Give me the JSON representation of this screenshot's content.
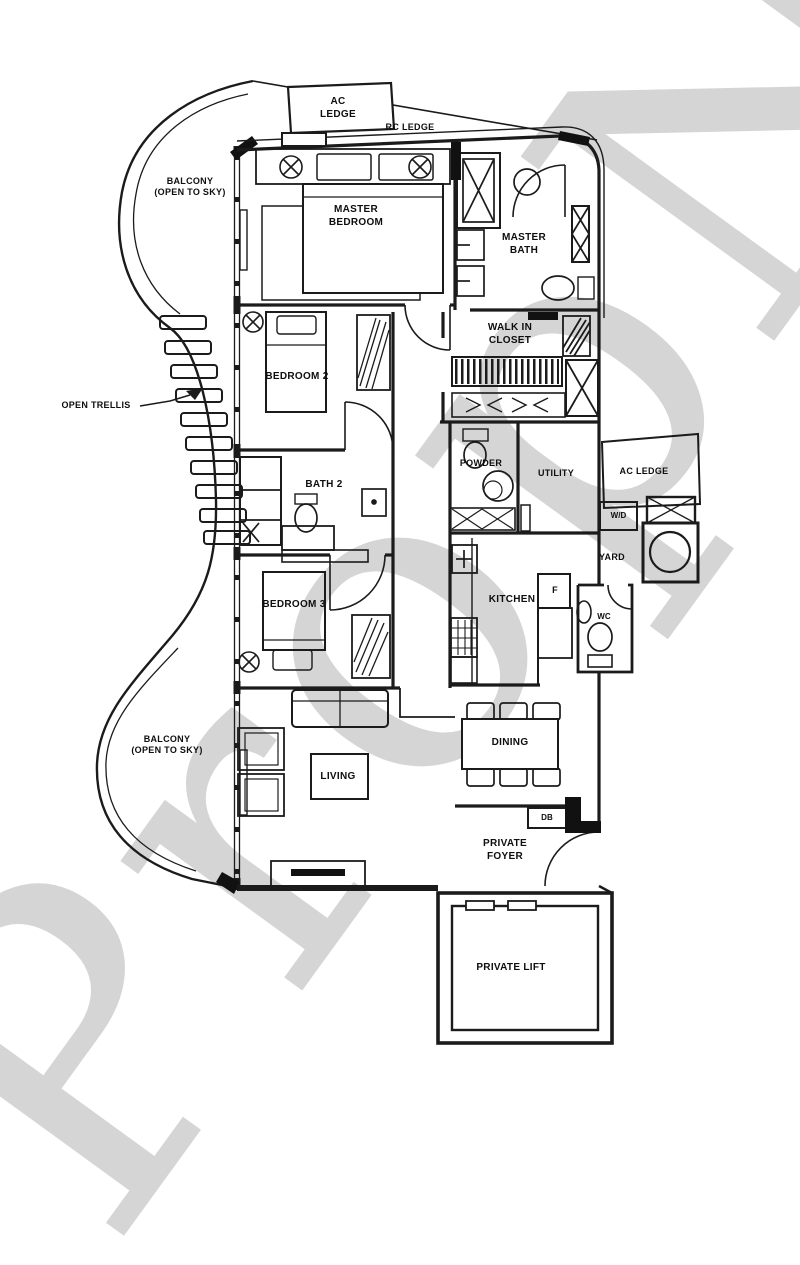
{
  "watermark": {
    "text": "PropNex",
    "color": "#d2d2d2"
  },
  "colors": {
    "background": "#ffffff",
    "line": "#1b1b1b",
    "label": "#0e0e0e"
  },
  "labels": {
    "ac_ledge_top": "AC\nLEDGE",
    "rc_ledge": "RC LEDGE",
    "balcony_top": "BALCONY\n(OPEN TO SKY)",
    "master_bedroom": "MASTER\nBEDROOM",
    "master_bath": "MASTER\nBATH",
    "walk_in_closet": "WALK IN\nCLOSET",
    "bedroom_2": "BEDROOM 2",
    "open_trellis": "OPEN TRELLIS",
    "bath_2": "BATH 2",
    "powder": "POWDER",
    "utility": "UTILITY",
    "ac_ledge_right": "AC LEDGE",
    "wd": "W/D",
    "yard": "YARD",
    "wc": "WC",
    "kitchen": "KITCHEN",
    "fridge": "F",
    "bedroom_3": "BEDROOM 3",
    "balcony_bottom": "BALCONY\n(OPEN TO SKY)",
    "living": "LIVING",
    "dining": "DINING",
    "db": "DB",
    "private_foyer": "PRIVATE\nFOYER",
    "private_lift": "PRIVATE LIFT"
  }
}
